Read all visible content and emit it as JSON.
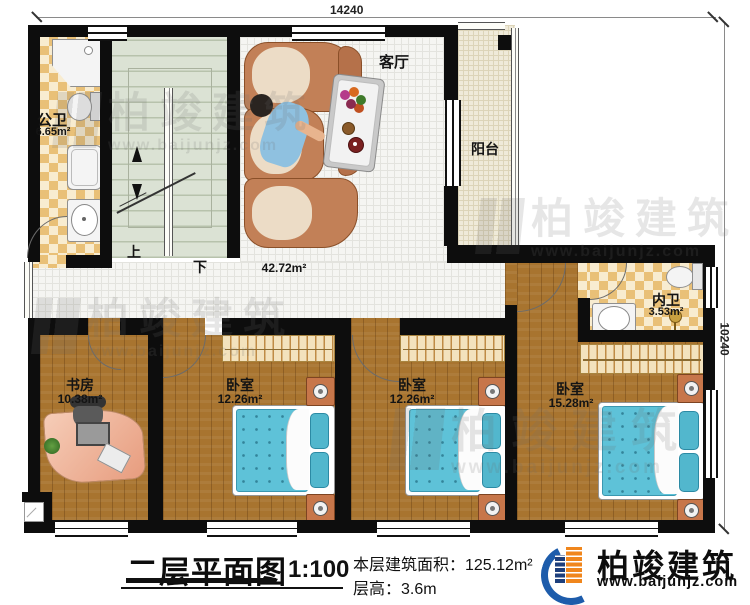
{
  "dimensions": {
    "width_mm": "14240",
    "height_mm": "10240"
  },
  "rooms": {
    "public_bath": {
      "name": "公卫",
      "area": "6.65m²"
    },
    "living": {
      "name": "客厅",
      "area": "42.72m²"
    },
    "balcony": {
      "name": "阳台"
    },
    "inner_bath": {
      "name": "内卫",
      "area": "3.53m²"
    },
    "study": {
      "name": "书房",
      "area": "10.38m²"
    },
    "bedroom1": {
      "name": "卧室",
      "area": "12.26m²"
    },
    "bedroom2": {
      "name": "卧室",
      "area": "12.26m²"
    },
    "master_bedroom": {
      "name": "卧室",
      "area": "15.28m²"
    }
  },
  "stairs": {
    "up": "上",
    "down": "下"
  },
  "title_block": {
    "title": "二层平面图",
    "scale": "1:100",
    "floor_area": "本层建筑面积：125.12m²",
    "floor_height": "层高：3.6m"
  },
  "brand": {
    "name": "柏竣建筑",
    "website": "www.baijunjz.com"
  },
  "watermark": {
    "name": "柏竣建筑",
    "website": "www.baijunjz.com"
  },
  "colors": {
    "wall": "#0d0d0d",
    "bed": "#5ec2d8",
    "tile": "#e9c077",
    "logo_blue": "#1d5cab",
    "logo_orange": "#f0861c"
  }
}
